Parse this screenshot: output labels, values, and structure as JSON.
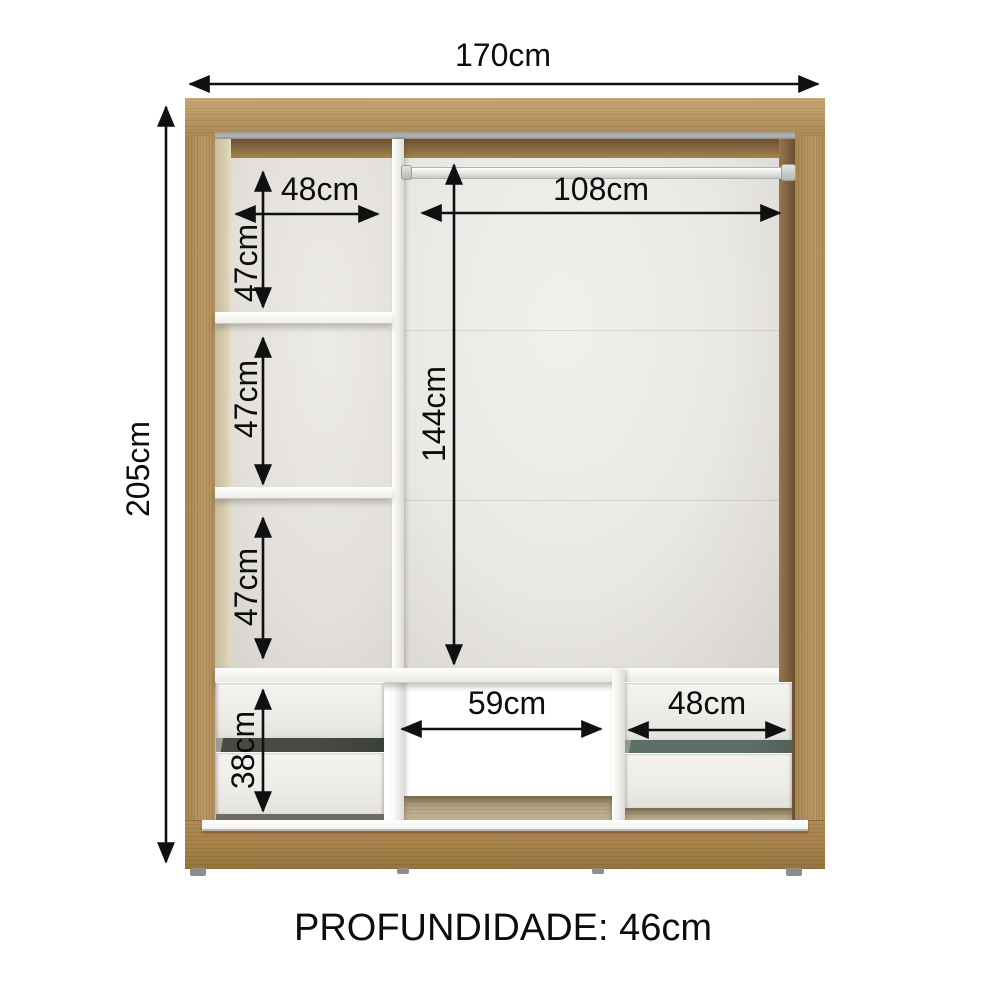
{
  "annotations": {
    "overall_width": "170cm",
    "overall_height": "205cm",
    "left_compartment_width": "48cm",
    "hanging_rod_width": "108cm",
    "left_section_1_height": "47cm",
    "left_section_2_height": "47cm",
    "left_section_3_height": "47cm",
    "main_compartment_height": "144cm",
    "drawer_unit_height": "38cm",
    "center_opening_width": "59cm",
    "right_drawer_width": "48cm"
  },
  "footer": {
    "depth_label": "PROFUNDIDADE: 46cm"
  },
  "colors": {
    "wood_frame": "#b5925e",
    "wood_dark_bevel": "#7c5f3b",
    "interior_back": "#eae8e4",
    "drawer_front": "#eeedea",
    "annotation_ink": "#101010",
    "background": "#ffffff"
  }
}
